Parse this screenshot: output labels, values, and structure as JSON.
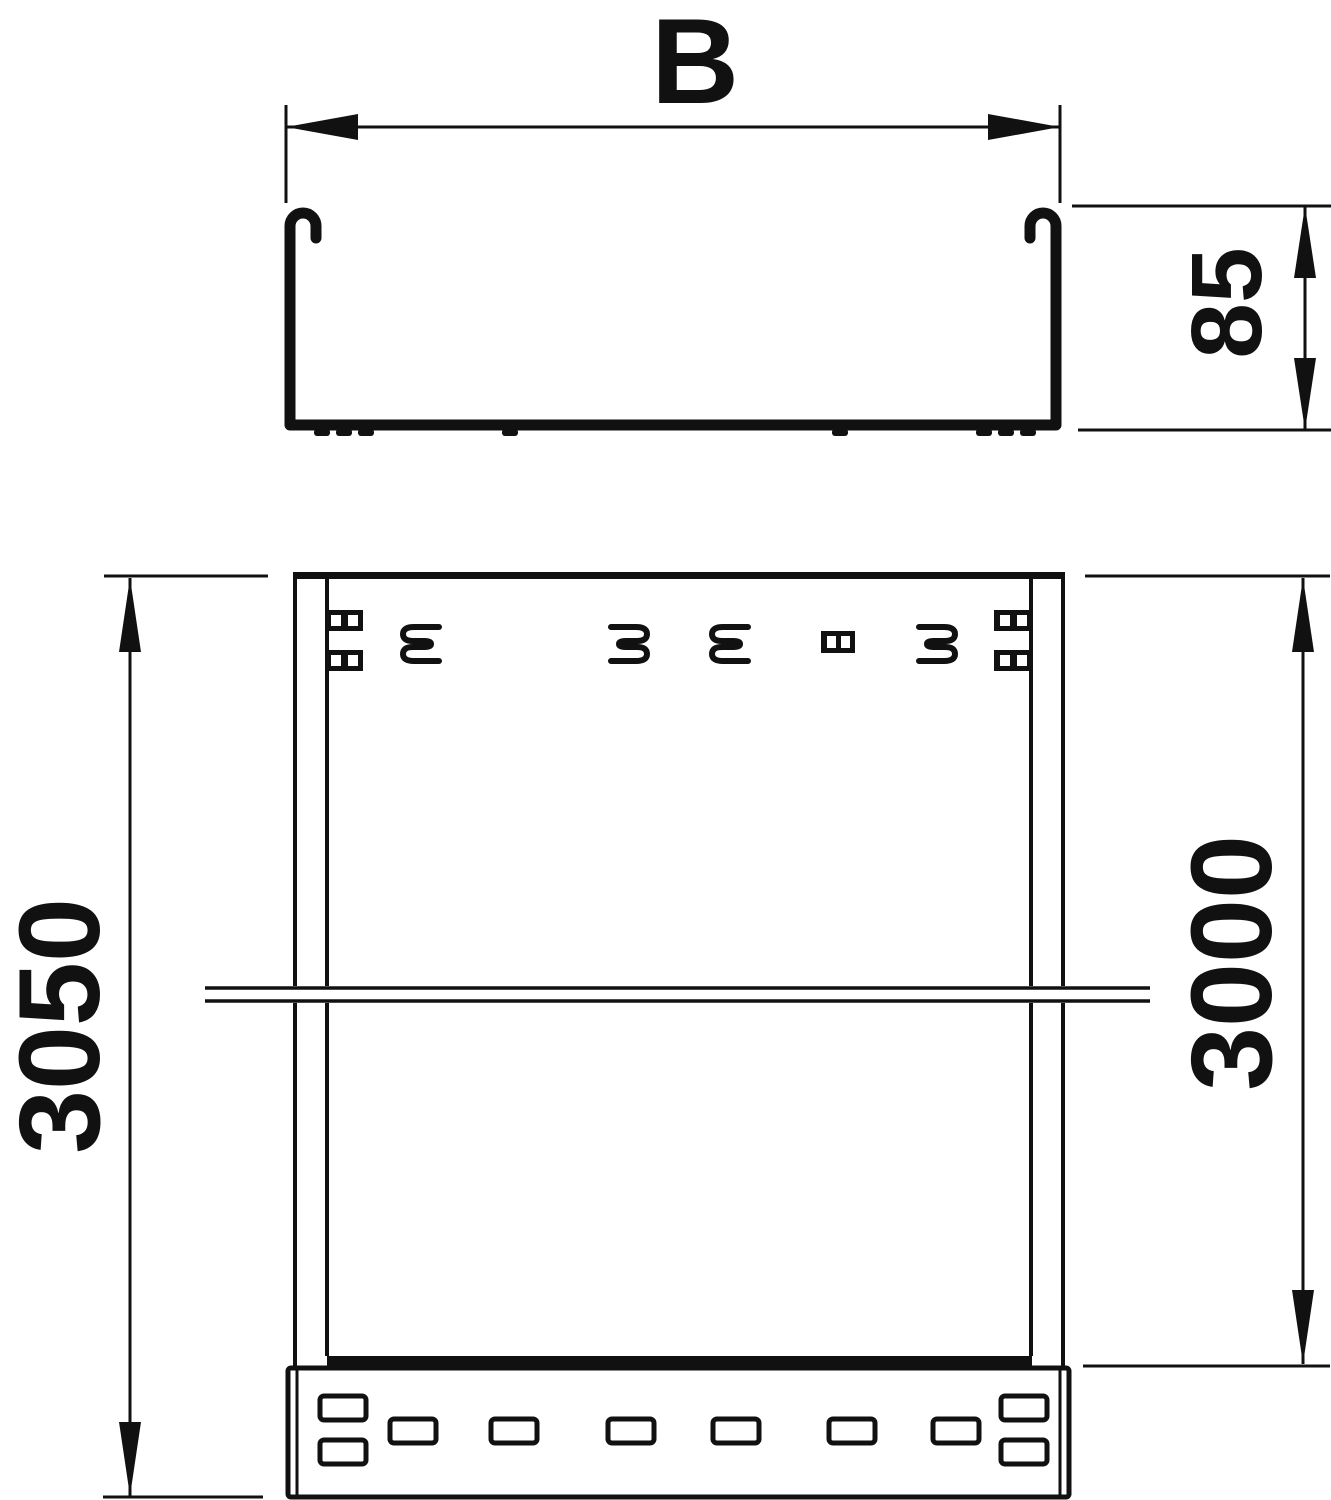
{
  "drawing": {
    "type": "technical-dimension-drawing",
    "views": {
      "cross_section": "cable tray profile",
      "plan": "cable tray top view with coupler"
    },
    "dimensions": {
      "width_label": "B",
      "height_label": "85",
      "total_length_label": "3050",
      "rail_length_label": "3000"
    },
    "colors": {
      "line": "#111111",
      "background": "#ffffff"
    }
  }
}
